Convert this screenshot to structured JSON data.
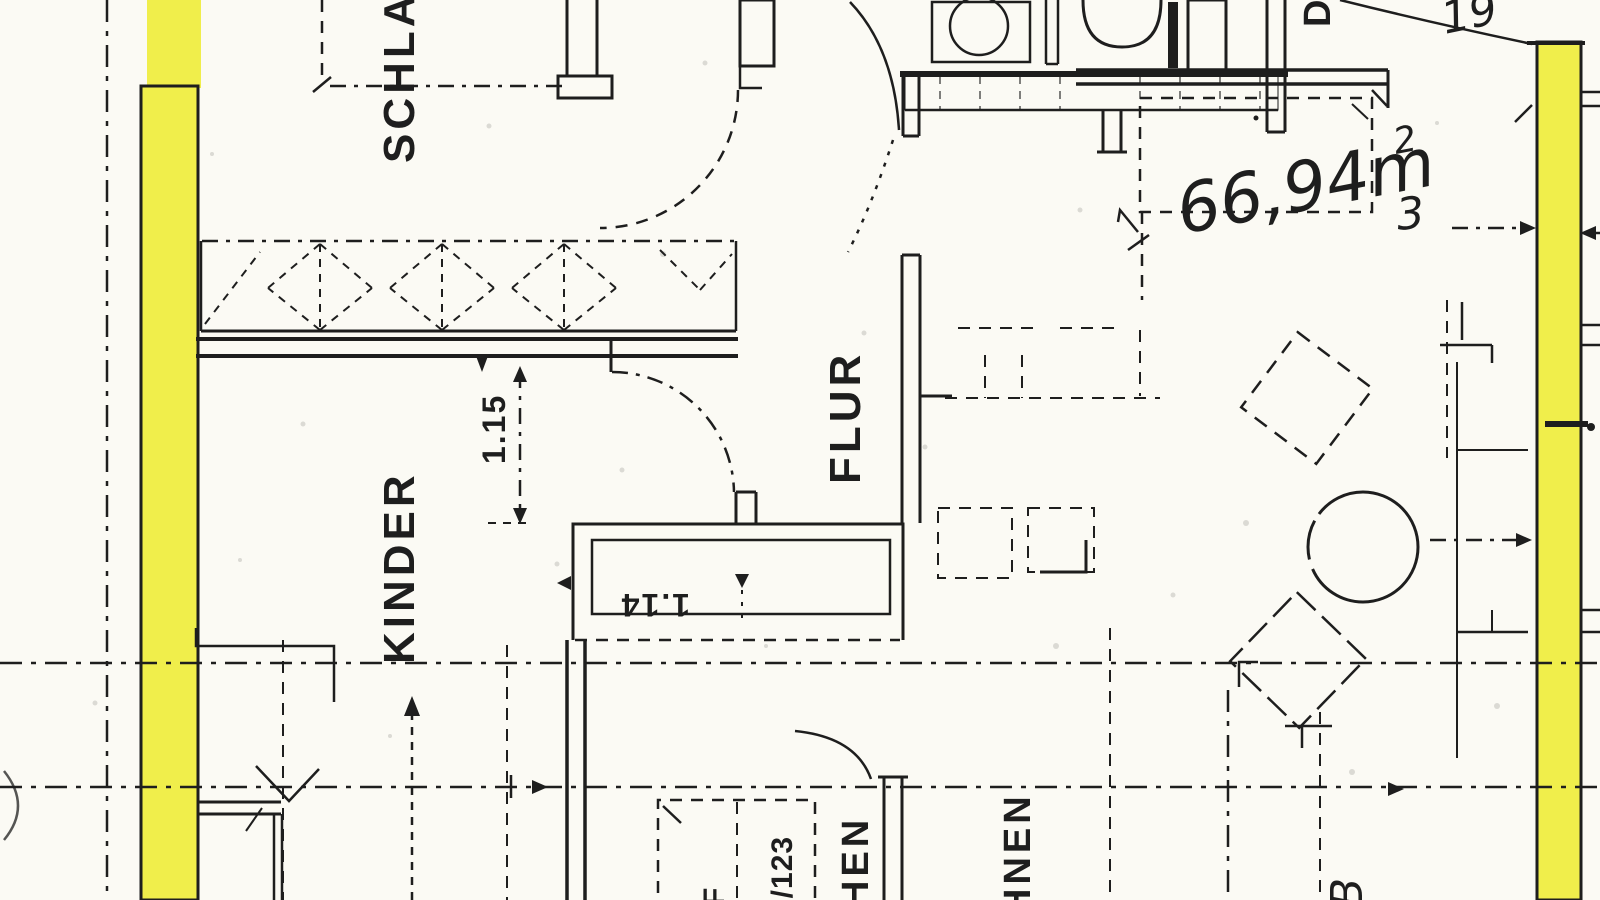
{
  "plan": {
    "room_labels": {
      "schlaf": "SCHLAF",
      "flur": "FLUR",
      "kinder": "KINDER",
      "kochen_partial": "HEN",
      "wohnen_partial": "HNEN",
      "top_right_partial": "D"
    },
    "dimensions": {
      "flur_passage": "1.15",
      "shaft": "1.14"
    },
    "handwritten": {
      "area_value": "66,94m",
      "area_exponent": "2",
      "top_right_note": "19",
      "window_note": "3",
      "bottom_right_partial": "B"
    },
    "plan_reference": {
      "letter_partial": "F",
      "number_partial": "5/123"
    },
    "colors": {
      "paper": "#fbfaf4",
      "ink": "#1e1e1e",
      "highlighter": "#f0ee4b"
    }
  }
}
